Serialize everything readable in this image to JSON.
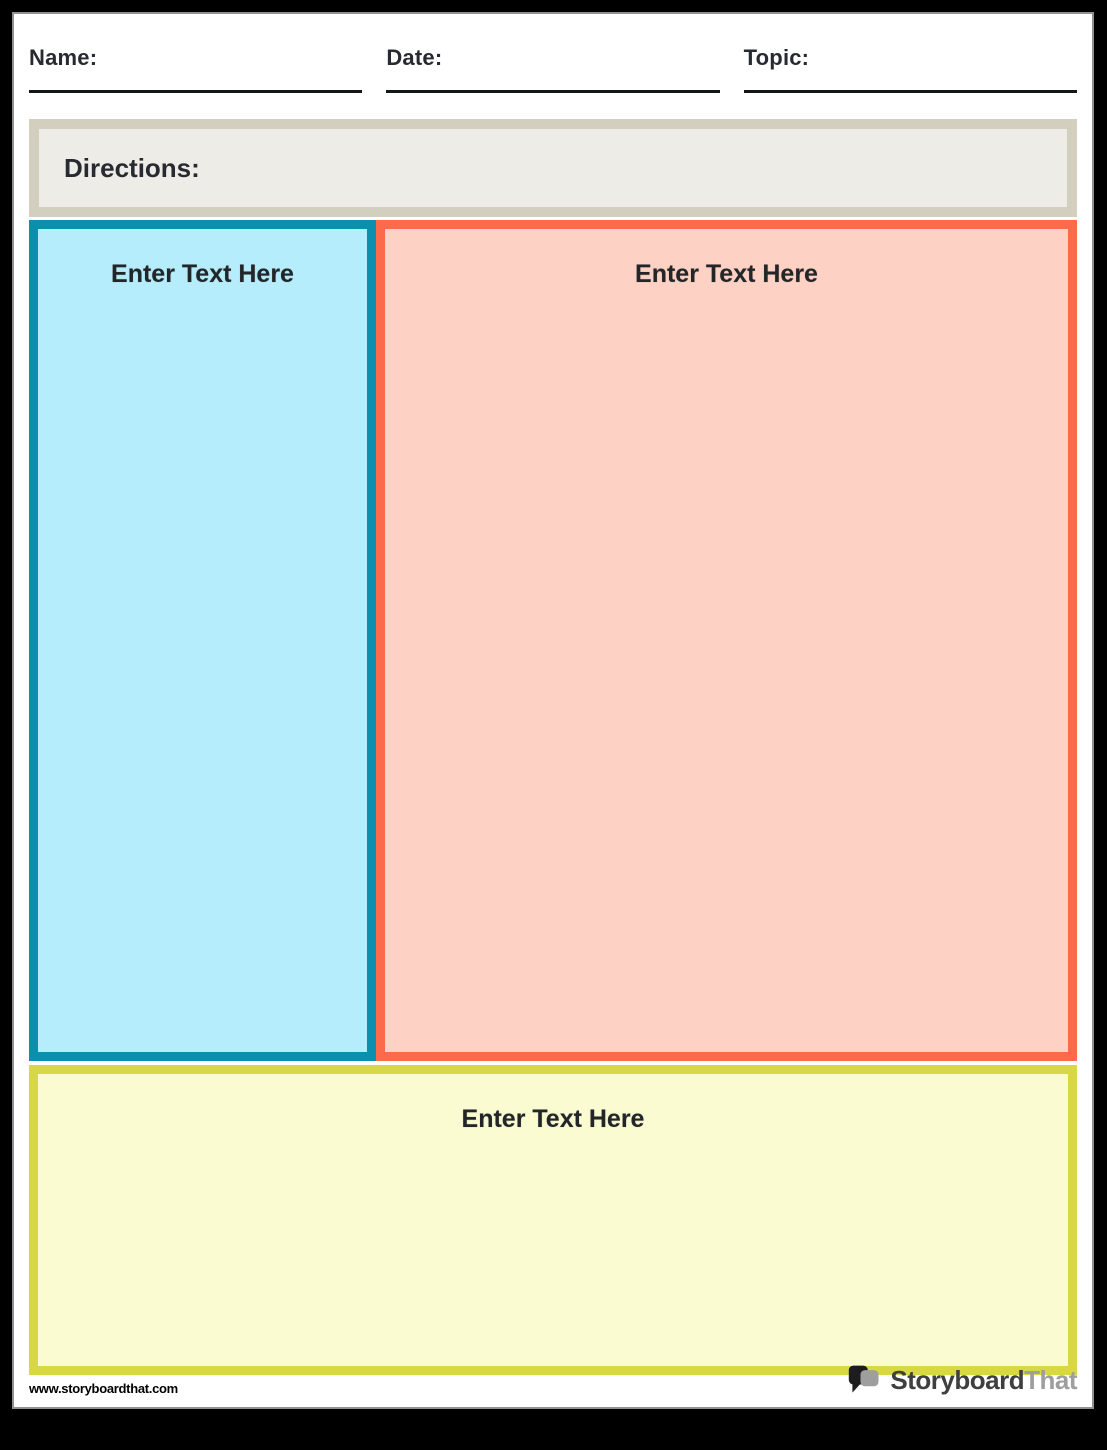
{
  "header": {
    "fields": [
      {
        "id": "name",
        "label": "Name:"
      },
      {
        "id": "date",
        "label": "Date:"
      },
      {
        "id": "topic",
        "label": "Topic:"
      }
    ]
  },
  "directions": {
    "label": "Directions:"
  },
  "boxes": [
    {
      "id": "left",
      "placeholder": "Enter Text Here"
    },
    {
      "id": "right",
      "placeholder": "Enter Text Here"
    },
    {
      "id": "bottom",
      "placeholder": "Enter Text Here"
    }
  ],
  "footer": {
    "website": "www.storyboardthat.com",
    "logo": {
      "part1": "Storyboard",
      "part2": "That"
    }
  },
  "colors": {
    "teal_border": "#0a8fad",
    "blue_fill": "#b5edfc",
    "orange_border": "#fb6b4b",
    "salmon_fill": "#fdd1c4",
    "yellow_border": "#d7d843",
    "yellow_fill": "#fbfbd1",
    "directions_border": "#d2cfbf",
    "directions_fill": "#edece7",
    "text_dark": "#272b31",
    "line_black": "#14171a",
    "page_border": "#919191",
    "logo_gray": "#9e9e9e",
    "logo_dark": "#3f3f3f"
  }
}
